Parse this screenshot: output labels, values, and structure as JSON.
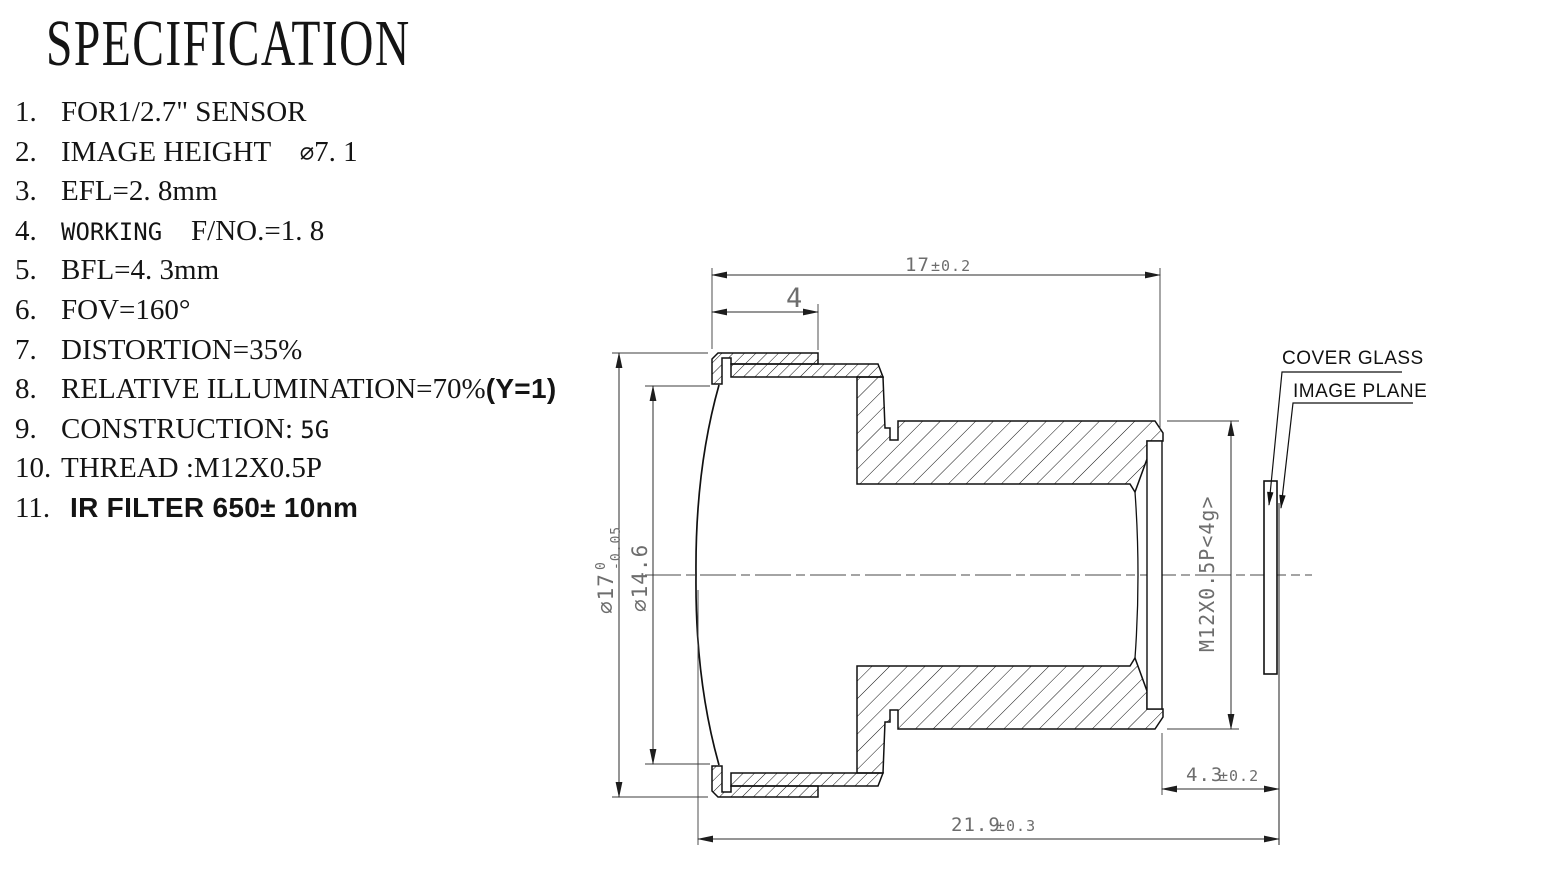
{
  "title": "SPECIFICATION",
  "spec_items": [
    {
      "num": "1.",
      "parts": [
        {
          "text": "FOR1/2.7\" SENSOR",
          "style": "serif"
        }
      ]
    },
    {
      "num": "2.",
      "parts": [
        {
          "text": "IMAGE HEIGHT    ",
          "style": "serif"
        },
        {
          "text": "∅",
          "style": "cad"
        },
        {
          "text": "7. 1",
          "style": "serif"
        }
      ]
    },
    {
      "num": "3.",
      "parts": [
        {
          "text": "EFL=2. 8mm",
          "style": "serif"
        }
      ]
    },
    {
      "num": "4.",
      "parts": [
        {
          "text": "WORKING  ",
          "style": "cad"
        },
        {
          "text": "F/NO.=1. 8",
          "style": "serif"
        }
      ]
    },
    {
      "num": "5.",
      "parts": [
        {
          "text": "BFL=4. 3mm",
          "style": "serif"
        }
      ]
    },
    {
      "num": "6.",
      "parts": [
        {
          "text": "FOV=160°",
          "style": "serif"
        }
      ]
    },
    {
      "num": "7.",
      "parts": [
        {
          "text": "DISTORTION=35%",
          "style": "serif"
        }
      ]
    },
    {
      "num": "8.",
      "parts": [
        {
          "text": "RELATIVE ILLUMINATION=70%",
          "style": "serif"
        },
        {
          "text": "(Y=1)",
          "style": "sans"
        }
      ]
    },
    {
      "num": "9.",
      "parts": [
        {
          "text": "CONSTRUCTION: ",
          "style": "serif"
        },
        {
          "text": "5G",
          "style": "cad"
        }
      ]
    },
    {
      "num": "10.",
      "parts": [
        {
          "text": "THREAD :M12X0.5P",
          "style": "serif"
        }
      ]
    },
    {
      "num": "11.",
      "parts": [
        {
          "text": "IR FILTER 650± 10nm",
          "style": "sans"
        }
      ]
    }
  ],
  "drawing": {
    "dim_length_17": {
      "value": "17",
      "tol": "±0.2"
    },
    "dim_flange_4": {
      "value": "4"
    },
    "dim_overall_219": {
      "value": "21.9",
      "tol": "±0.3"
    },
    "dim_back_43": {
      "value": "4.3",
      "tol": "±0.2"
    },
    "dim_outer_dia": {
      "value": "∅17",
      "tol_upper": "0",
      "tol_lower": "-0.05"
    },
    "dim_front_dia": {
      "value": "∅14.6"
    },
    "dim_thread": {
      "value": "M12X0.5P<4g>"
    },
    "label_cover_glass": "COVER GLASS",
    "label_image_plane": "IMAGE PLANE"
  },
  "colors": {
    "background": "#ffffff",
    "part_line": "#111111",
    "dimension_line": "#2b2b2b",
    "dimension_text": "#6d6d6d"
  }
}
